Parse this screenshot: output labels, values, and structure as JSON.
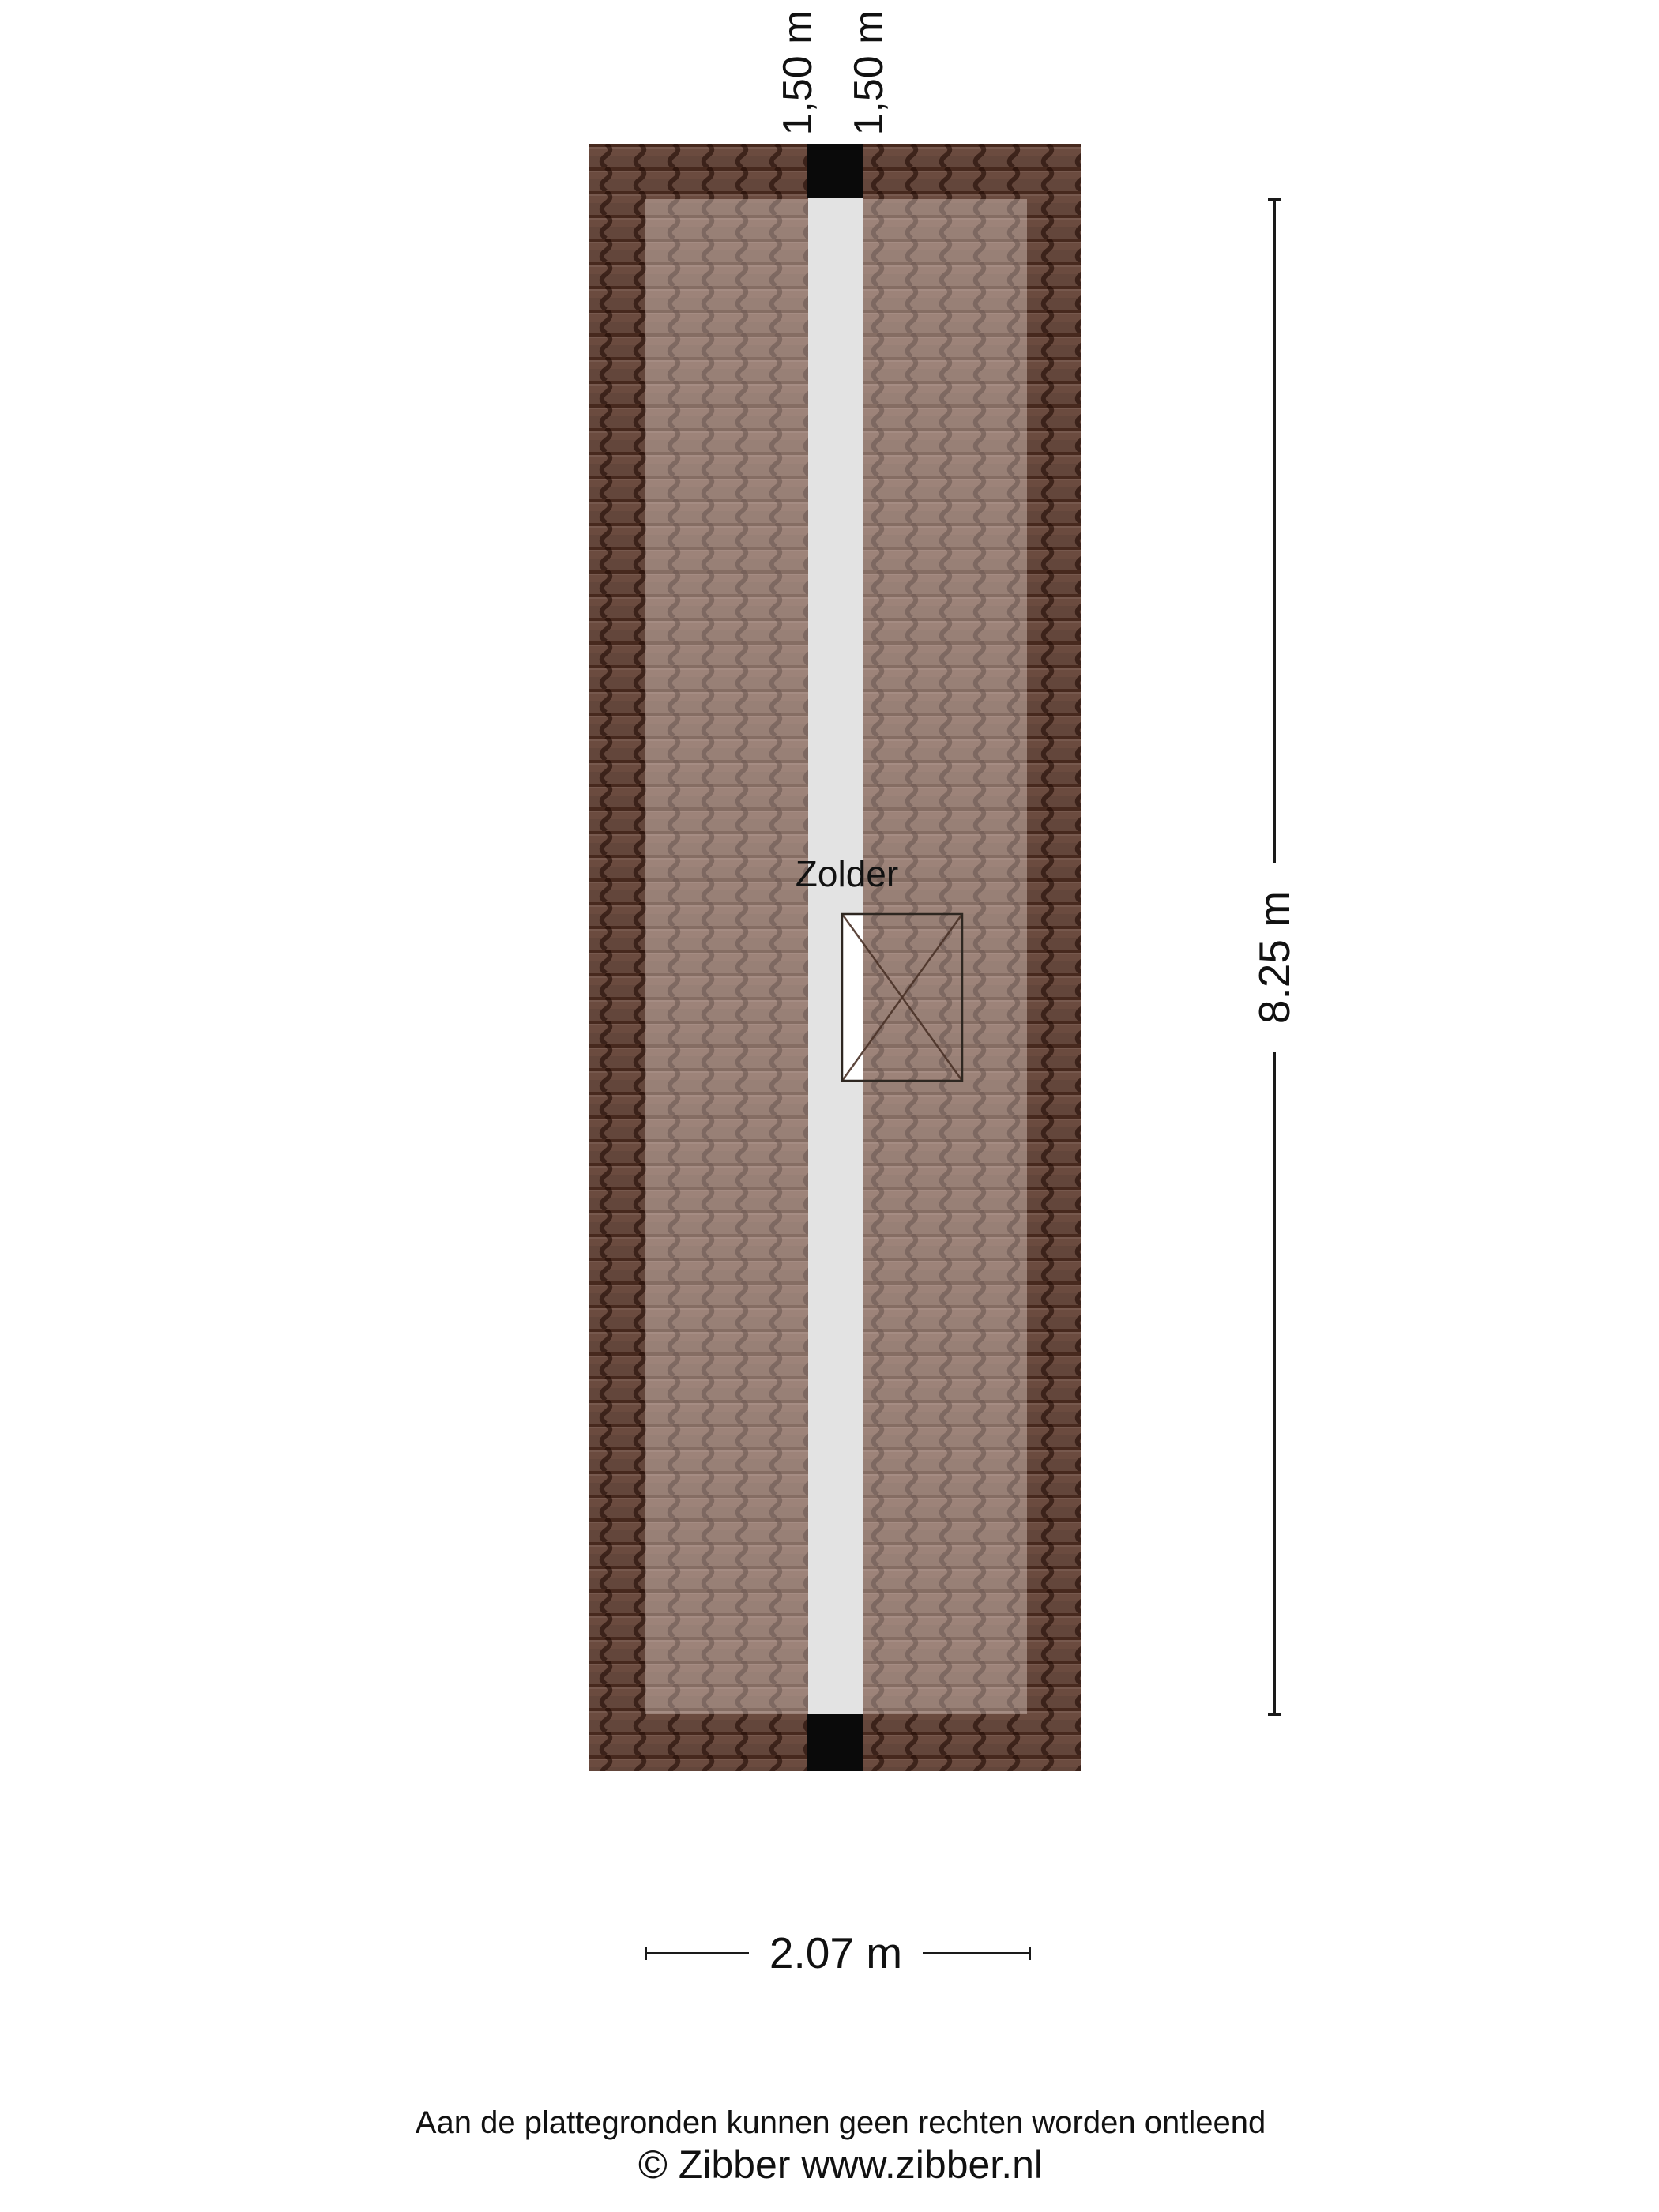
{
  "colors": {
    "page-bg": "#ffffff",
    "roof-base": "#6b4b3f",
    "roof-gap": "#2e1209",
    "roof-wave": "#1f0a04",
    "room-overlay": "rgba(255,241,235,0.34)",
    "floor-strip": "#e3e3e3",
    "block": "#0a0a0a",
    "window-fill": "#ffffff",
    "window-line": "#4a3228",
    "window-border": "#2e2721",
    "dim-line": "#1a1a1a",
    "text": "#111111"
  },
  "plan": {
    "room": {
      "label": "Zolder"
    },
    "height_lines": [
      {
        "label": "1,50 m"
      },
      {
        "label": "1,50 m"
      }
    ],
    "dimensions": {
      "height": {
        "label": "8.25 m"
      },
      "width": {
        "label": "2.07 m"
      }
    }
  },
  "footer": {
    "disclaimer": "Aan de plattegronden kunnen geen rechten worden ontleend",
    "copyright": "© Zibber www.zibber.nl"
  }
}
